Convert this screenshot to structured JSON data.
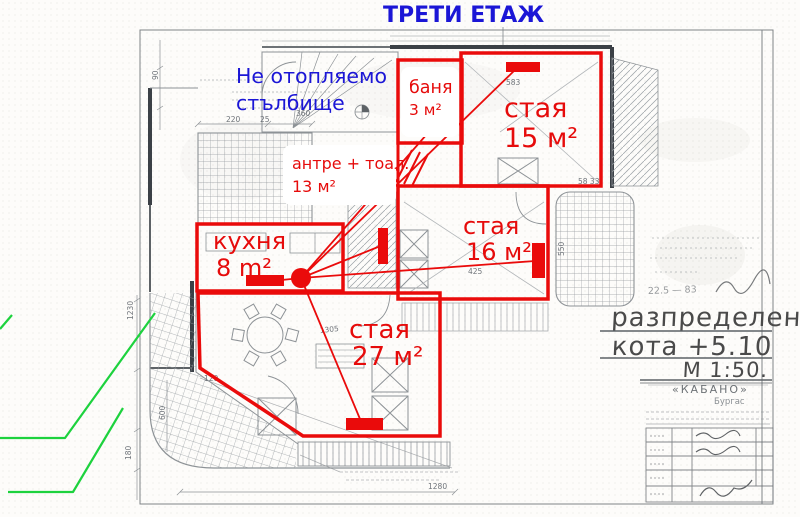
{
  "page_title": "ТРЕТИ ЕТАЖ",
  "note_blue": {
    "line1": "Не отопляемо",
    "line2": "стълбище"
  },
  "rooms": {
    "banya": {
      "name": "баня",
      "area": "3 м²"
    },
    "staya15": {
      "name": "стая",
      "area": "15 м²"
    },
    "antre": {
      "name": "антре + тоал.",
      "area": "13 м²"
    },
    "kuhnya": {
      "name": "кухня",
      "area": "8 m²"
    },
    "staya16": {
      "name": "стая",
      "area": "16 м²"
    },
    "staya27": {
      "name": "стая",
      "area": "27 м²"
    }
  },
  "legend": {
    "title": "разпределение",
    "subtitle": "кота +5.10",
    "scale": "М 1:50.",
    "company": "«КАБАНО»",
    "city": "Бургас",
    "handnote": "22.5 — 83"
  },
  "dims": [
    {
      "t": "220"
    },
    {
      "t": "25"
    },
    {
      "t": "583"
    },
    {
      "t": "360"
    },
    {
      "t": "1305"
    },
    {
      "t": "425"
    },
    {
      "t": "120"
    },
    {
      "t": "1280"
    },
    {
      "t": "1230"
    },
    {
      "t": "180"
    },
    {
      "t": "600"
    },
    {
      "t": "550"
    },
    {
      "t": "58 33"
    },
    {
      "t": "90"
    }
  ],
  "colors": {
    "annotation_red": "#ea0b0b",
    "note_blue": "#1b16d6",
    "marker_green": "#1dd23e",
    "pencil_gray": "#8d9296",
    "wall_dark": "#3b4046"
  }
}
